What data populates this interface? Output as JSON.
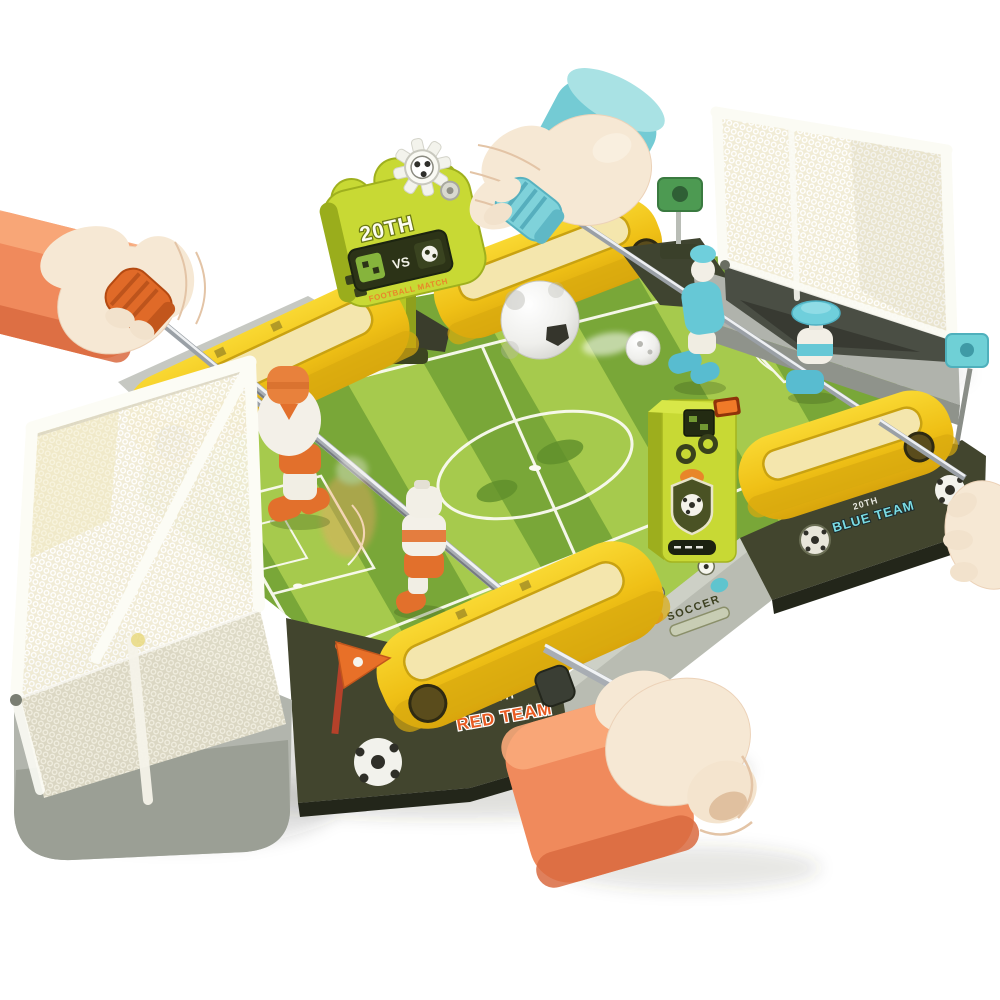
{
  "scene": {
    "description": "Product photo of a tabletop foosball (table football) toy: green striped pitch, yellow slide rails, two white mesh goals, steel rods and four cartoon hands gripping handles",
    "background": "#ffffff"
  },
  "scoreboard": {
    "title": "20TH",
    "screen_label": "VS",
    "subtitle": "FOOTBALL MATCH"
  },
  "branding": {
    "front_line1": "20TH",
    "front_line2": "RED TEAM",
    "side_line1": "20TH",
    "side_line2": "BLUE TEAM",
    "emblem": "SOCCER"
  },
  "teams": {
    "left": {
      "color_name": "orange",
      "players_visible": 2
    },
    "right": {
      "color_name": "blue",
      "players_visible": 2
    }
  },
  "palette": {
    "pitch_green": "#79a738",
    "pitch_stripe": "#a6ca4d",
    "rail_yellow": "#f2c51a",
    "lime_green": "#c8d934",
    "skirt_olive": "#42452e",
    "net_cream": "#f2edd7",
    "skin": "#f6e8d4",
    "sleeve_orange": "#f08a5c",
    "sleeve_teal": "#74cbd4",
    "team_red": "#e85c24",
    "team_blue": "#7adce4",
    "rod_silver": "#b9bec4"
  },
  "objects": [
    "left goal with white net on gray base",
    "right goal with white net",
    "orange corner pennant flag",
    "green flag",
    "teal flag",
    "large white soccer ball in motion",
    "small white ball with motion blur",
    "electronic scorer tower",
    "cloud-shaped scoreboard sign with gear ornament",
    "four steel player rods with knurled grips"
  ]
}
